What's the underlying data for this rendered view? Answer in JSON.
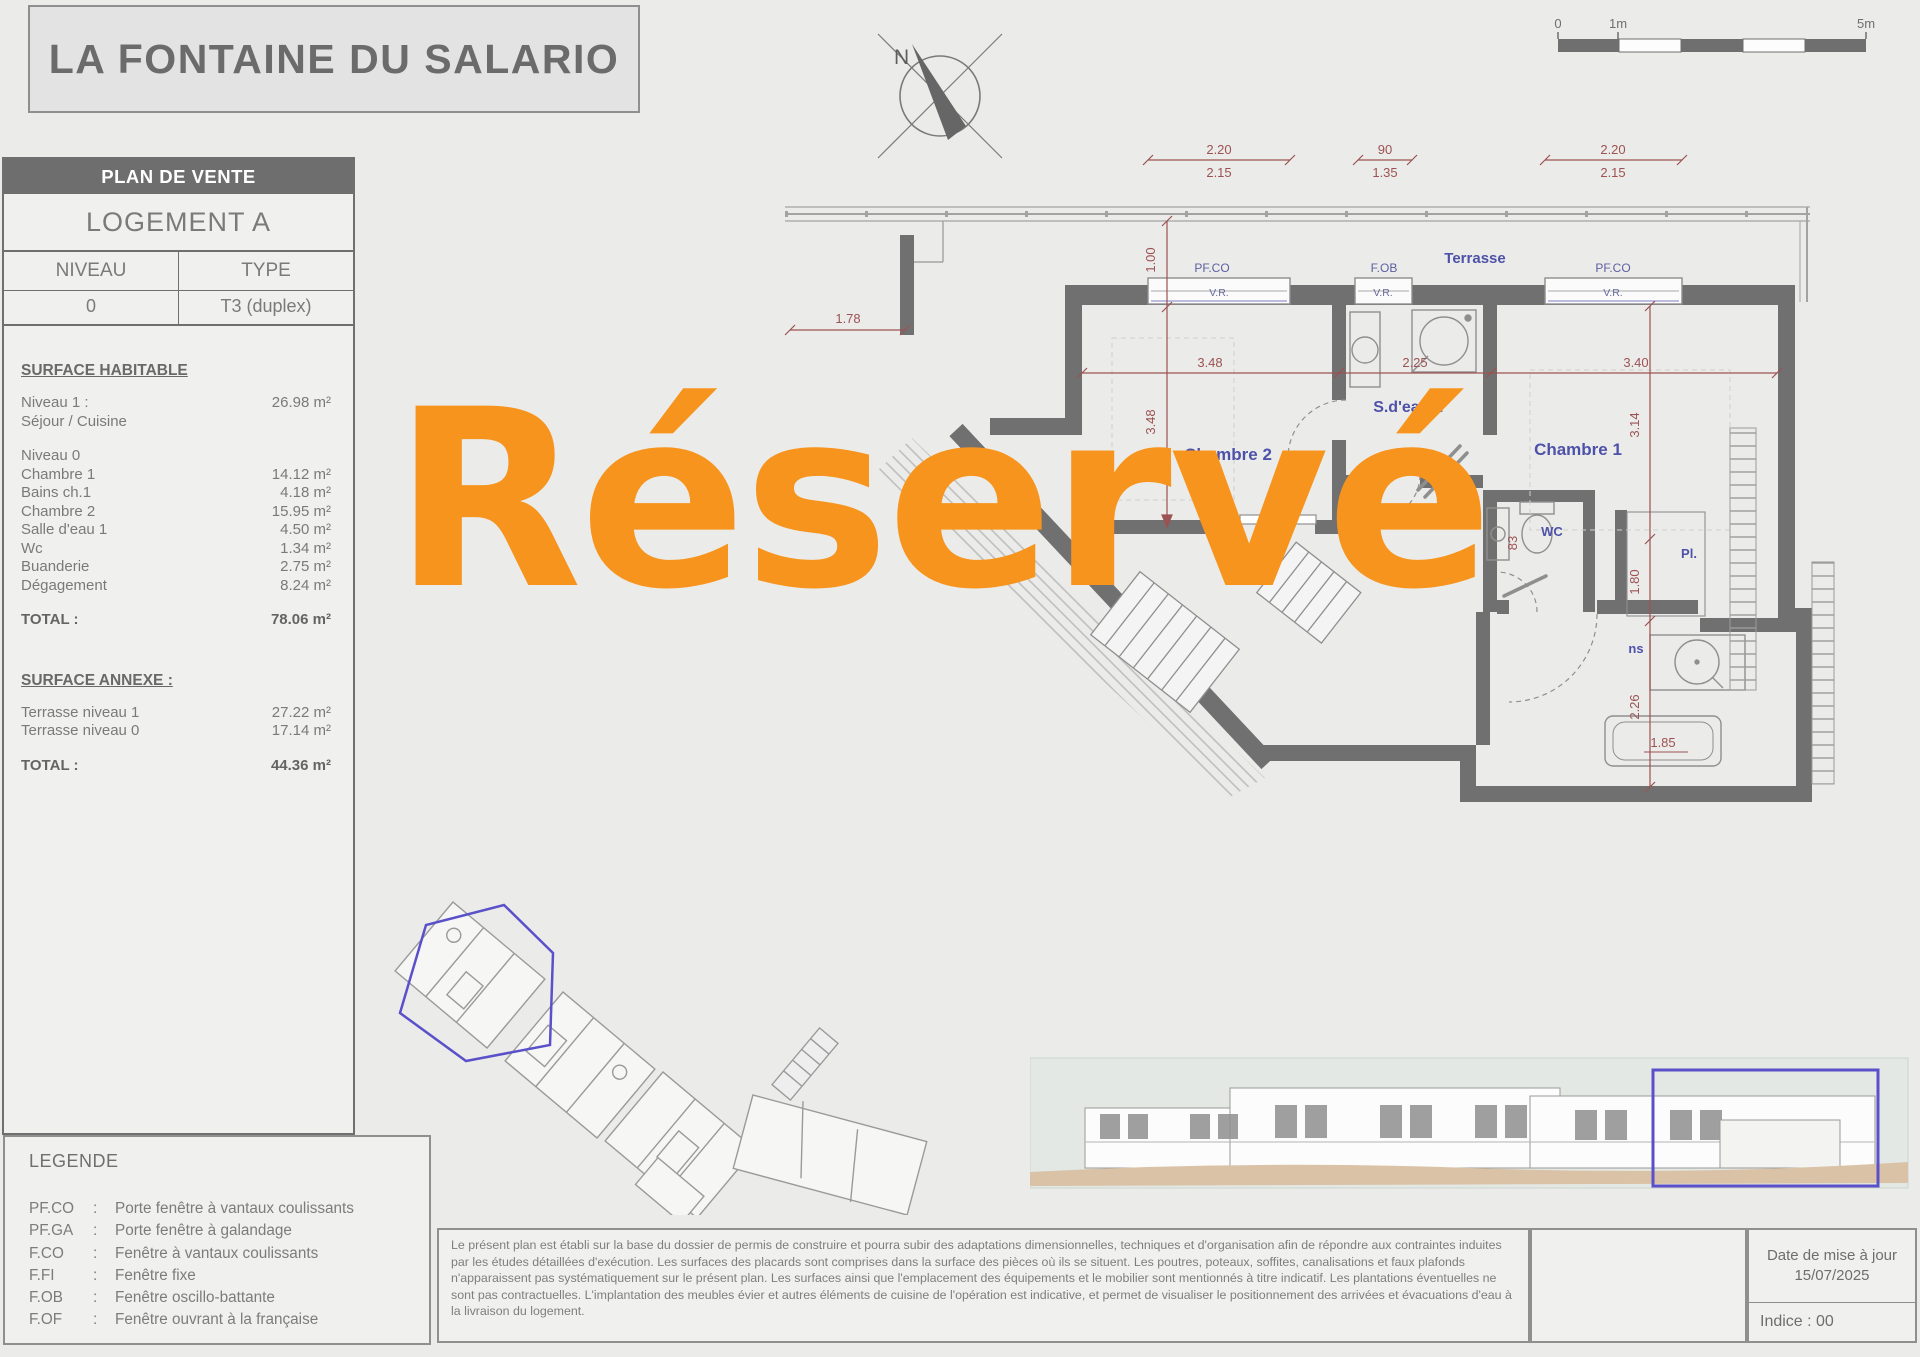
{
  "title": "LA FONTAINE DU SALARIO",
  "watermark": "Réservé",
  "compass": {
    "north": "N"
  },
  "scale_bar": {
    "t0": "0",
    "t1": "1m",
    "t5": "5m"
  },
  "sidebar": {
    "header": "PLAN DE VENTE",
    "logement": "LOGEMENT A",
    "niveau_header": "NIVEAU",
    "type_header": "TYPE",
    "niveau_value": "0",
    "type_value": "T3 (duplex)",
    "surface_habitable": {
      "title": "SURFACE HABITABLE",
      "niveau1_label": "Niveau 1 :",
      "niveau1_value": "26.98 m²",
      "niveau1_sub": "Séjour / Cuisine",
      "niveau0_label": "Niveau 0",
      "rooms": [
        {
          "label": "Chambre 1",
          "value": "14.12 m²"
        },
        {
          "label": "Bains ch.1",
          "value": "4.18 m²"
        },
        {
          "label": "Chambre 2",
          "value": "15.95 m²"
        },
        {
          "label": "Salle d'eau 1",
          "value": "4.50 m²"
        },
        {
          "label": "Wc",
          "value": "1.34 m²"
        },
        {
          "label": "Buanderie",
          "value": "2.75 m²"
        },
        {
          "label": "Dégagement",
          "value": "8.24 m²"
        }
      ],
      "total_label": "TOTAL :",
      "total_value": "78.06 m²"
    },
    "surface_annexe": {
      "title": "SURFACE ANNEXE :",
      "rows": [
        {
          "label": "Terrasse niveau 1",
          "value": "27.22 m²"
        },
        {
          "label": "Terrasse niveau 0",
          "value": "17.14 m²"
        }
      ],
      "total_label": "TOTAL :",
      "total_value": "44.36 m²"
    }
  },
  "legende": {
    "title": "LEGENDE",
    "colon": ":",
    "items": [
      {
        "abbr": "PF.CO",
        "desc": "Porte fenêtre à vantaux coulissants"
      },
      {
        "abbr": "PF.GA",
        "desc": "Porte fenêtre à galandage"
      },
      {
        "abbr": "F.CO",
        "desc": "Fenêtre à vantaux coulissants"
      },
      {
        "abbr": "F.FI",
        "desc": "Fenêtre fixe"
      },
      {
        "abbr": "F.OB",
        "desc": "Fenêtre oscillo-battante"
      },
      {
        "abbr": "F.OF",
        "desc": "Fenêtre ouvrant à la française"
      }
    ]
  },
  "plan": {
    "rooms": {
      "terrasse": "Terrasse",
      "chambre2": "Chambre 2",
      "sdeau1": "S.d'eau 1",
      "chambre1": "Chambre 1",
      "dgt": "Dgt.",
      "wc": "WC",
      "pl_left": "Pl.",
      "pl_right": "Pl.",
      "bains_fragment": "ns"
    },
    "windows": {
      "w1_label": "PF.CO",
      "w2_label": "F.OB",
      "w3_label": "PF.CO",
      "vr": "V.R."
    },
    "dims": {
      "d220a": "2.20",
      "d215a": "2.15",
      "d90": "90",
      "d135": "1.35",
      "d220b": "2.20",
      "d215b": "2.15",
      "d178": "1.78",
      "d100": "1.00",
      "d348h": "3.48",
      "d348v": "3.48",
      "d225": "2.25",
      "d340": "3.40",
      "d314": "3.14",
      "d180": "1.80",
      "d226": "2.26",
      "d83": "83",
      "d185": "1.85"
    }
  },
  "footer": {
    "disclaimer": "Le présent plan est établi sur la base du dossier de permis de construire et pourra subir des adaptations dimensionnelles, techniques et d'organisation afin de répondre aux contraintes induites par les études détaillées d'exécution. Les surfaces des placards sont comprises dans la surface des pièces où ils se situent. Les poutres, poteaux, soffites, canalisations et faux plafonds n'apparaissent pas systématiquement sur le présent plan. Les surfaces ainsi que l'emplacement des équipements et le mobilier sont mentionnés à titre indicatif. Les plantations éventuelles ne sont pas contractuelles. L'implantation des meubles évier et autres éléments de cuisine de l'opération est indicative, et permet de visualiser le positionnement des arrivées et évacuations d'eau à la livraison du logement.",
    "date_label": "Date de mise à jour",
    "date_value": "15/07/2025",
    "indice": "Indice : 00"
  },
  "colors": {
    "accent_orange": "#f7941e",
    "label_blue": "#4e51a8",
    "dim_red": "#9c5252",
    "highlight_blue": "#5a50c9",
    "wall_gray": "#707070"
  }
}
